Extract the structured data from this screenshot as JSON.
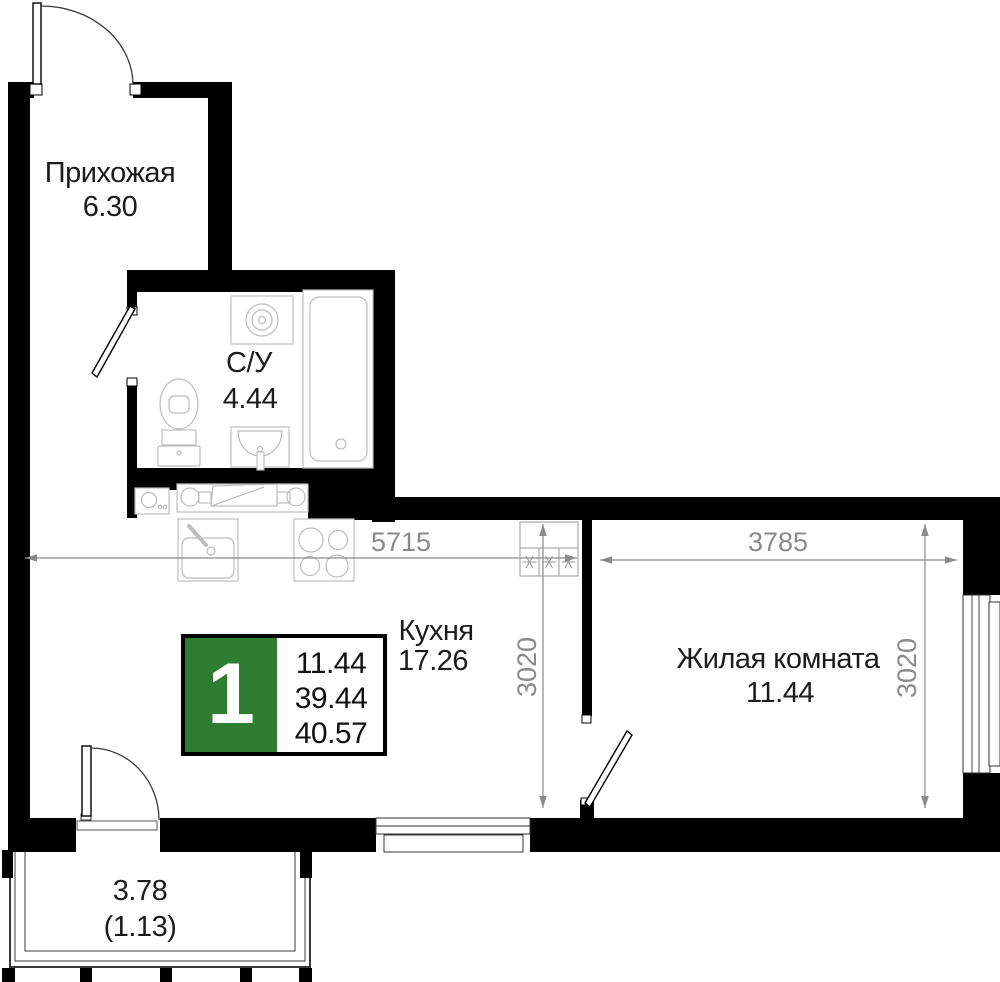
{
  "plan": {
    "badge": {
      "rooms_count": "1",
      "living_area": "11.44",
      "area_no_balcony": "39.44",
      "total_area": "40.57",
      "accent_color": "#2e7d33"
    },
    "rooms": {
      "hallway": {
        "name": "Прихожая",
        "area": "6.30"
      },
      "bathroom": {
        "name": "С/У",
        "area": "4.44"
      },
      "kitchen": {
        "name": "Кухня",
        "area": "17.26"
      },
      "living_room": {
        "name": "Жилая комната",
        "area": "11.44"
      },
      "balcony": {
        "area": "3.78",
        "area_reduced": "(1.13)"
      }
    },
    "dimensions": {
      "kitchen_width_mm": "5715",
      "living_width_mm": "3785",
      "kitchen_depth_mm": "3020",
      "living_depth_mm": "3020"
    },
    "colors": {
      "walls": "#000000",
      "dimension_text": "#8a8a8a",
      "fixtures": "#bdbdbd",
      "accent": "#2e7d33"
    }
  }
}
